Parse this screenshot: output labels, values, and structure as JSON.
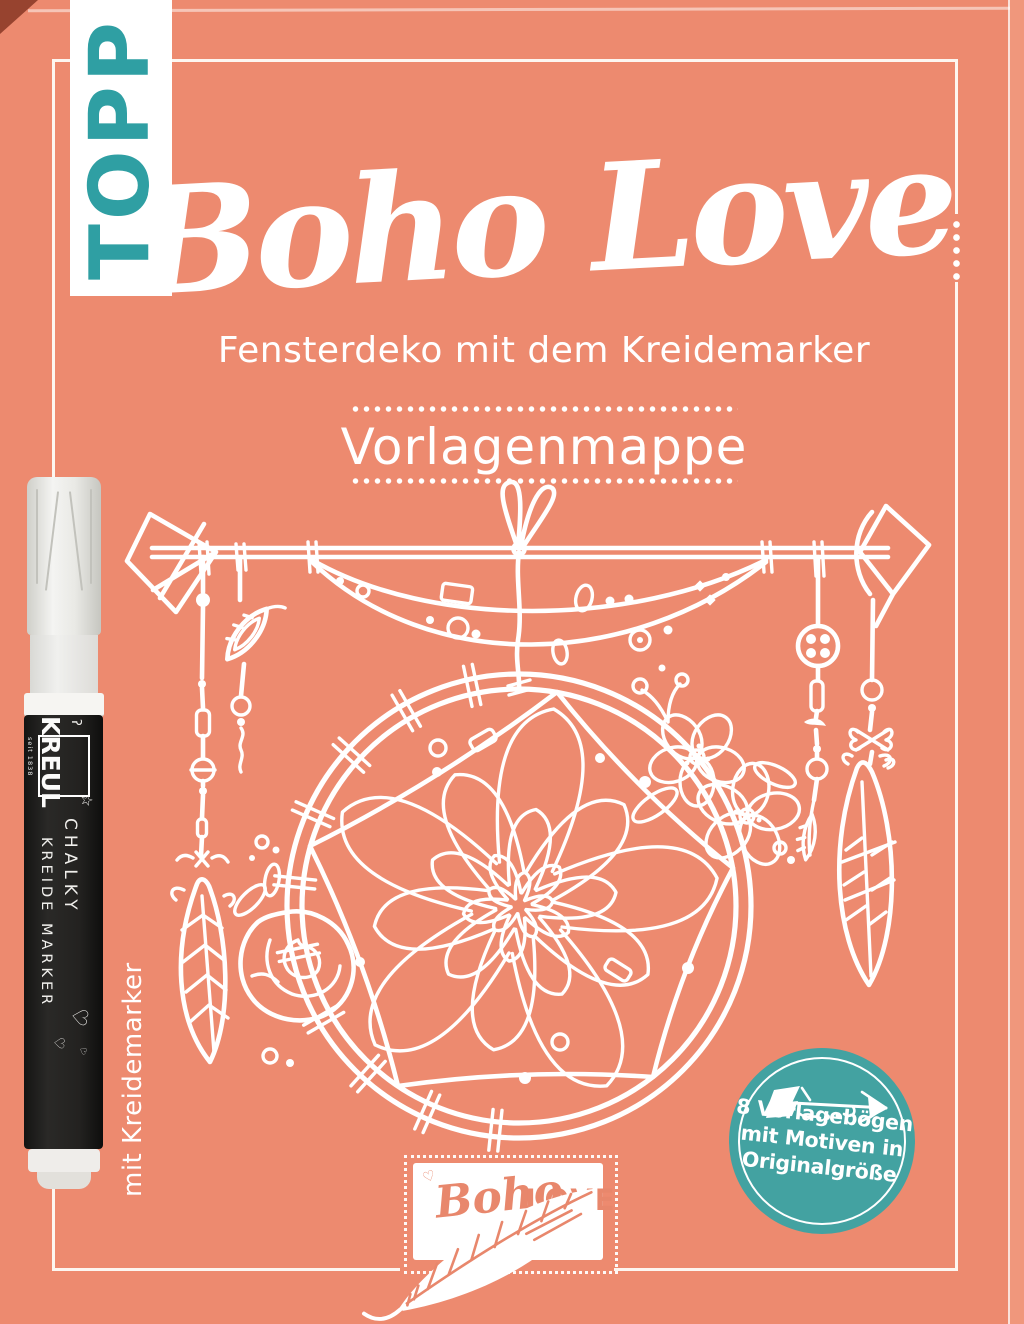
{
  "publisher": {
    "logo_text": "TOPP"
  },
  "title": "Boho Love",
  "subtitle": "Fensterdeko mit dem Kreidemarker",
  "edition_label": "Vorlagenmappe",
  "vertical_note": "mit Kreidemarker",
  "badge": {
    "line1": "8 Vorlagebögen",
    "line2": "mit Motiven in",
    "line3": "Originalgröße"
  },
  "brand_logo": {
    "script_text": "Boho",
    "caps_text": "LOVE"
  },
  "pen": {
    "brand": "KREUL",
    "brand_tagline": "seit 1838",
    "product_line1": "CHALKY",
    "product_line2": "KREIDE MARKER"
  },
  "colors": {
    "cover_coral": "#ED8A6F",
    "publisher_teal": "#2F9FA3",
    "badge_teal": "#43A2A1",
    "logo_coral": "#E8876C",
    "pen_black": "#232220",
    "line_white": "#FDF6F0"
  }
}
